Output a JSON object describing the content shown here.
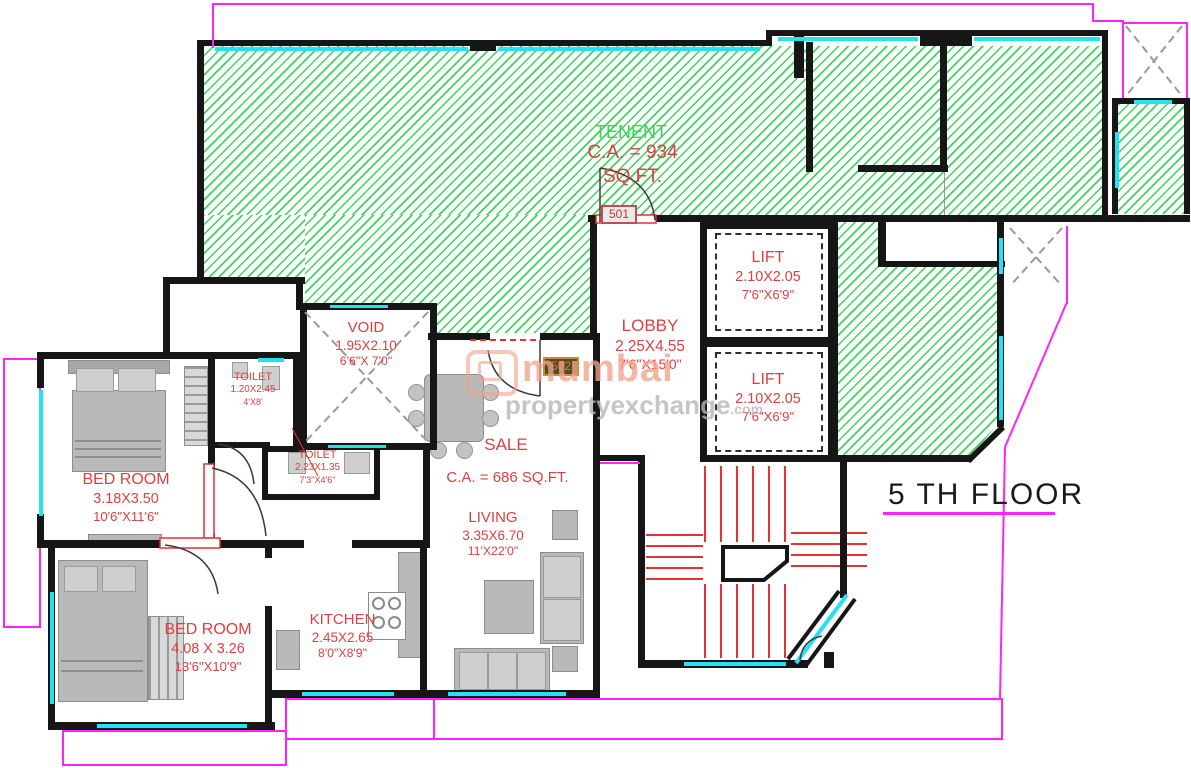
{
  "floor": {
    "title": "5 TH FLOOR"
  },
  "tenant": {
    "label": "TENENT",
    "area": "C.A. = 934 SQ.FT."
  },
  "sale": {
    "label": "SALE",
    "area": "C.A. = 686 SQ.FT."
  },
  "doors": {
    "unit_501": "501",
    "unit_502": "502"
  },
  "rooms": {
    "lobby": {
      "name": "LOBBY",
      "dim_m": "2.25X4.55",
      "dim_ft": "7'6\"X15'0\""
    },
    "lift_upper": {
      "name": "LIFT",
      "dim_m": "2.10X2.05",
      "dim_ft": "7'6\"X6'9\""
    },
    "lift_lower": {
      "name": "LIFT",
      "dim_m": "2.10X2.05",
      "dim_ft": "7'6\"X6'9\""
    },
    "void": {
      "name": "VOID",
      "dim_m": "1.95X2.10",
      "dim_ft": "6'6\"X 7'0\""
    },
    "toilet_small": {
      "name": "TOILET",
      "dim_m": "1.20X2.45",
      "dim_ft": "4'X8'"
    },
    "toilet_big": {
      "name": "TOILET",
      "dim_m": "2.23X1.35",
      "dim_ft": "7'3\"X4'6\""
    },
    "bedroom_top": {
      "name": "BED ROOM",
      "dim_m": "3.18X3.50",
      "dim_ft": "10'6\"X11'6\""
    },
    "bedroom_bottom": {
      "name": "BED ROOM",
      "dim_m": "4.08 X 3.26",
      "dim_ft": "13'6\"X10'9\""
    },
    "kitchen": {
      "name": "KITCHEN",
      "dim_m": "2.45X2.65",
      "dim_ft": "8'0\"X8'9\""
    },
    "living": {
      "name": "LIVING",
      "dim_m": "3.35X6.70",
      "dim_ft": "11'X22'0\""
    }
  },
  "watermark": {
    "word1": "mumbai",
    "word2": "propertyexchange",
    "suffix": ".com"
  },
  "colors": {
    "hatch_green": "#3bd65e",
    "label_red": "#dd4040",
    "window_cyan": "#23e2f2",
    "boundary_magenta": "#ff22ff",
    "wall_black": "#161616",
    "stair_red": "#e23232"
  }
}
